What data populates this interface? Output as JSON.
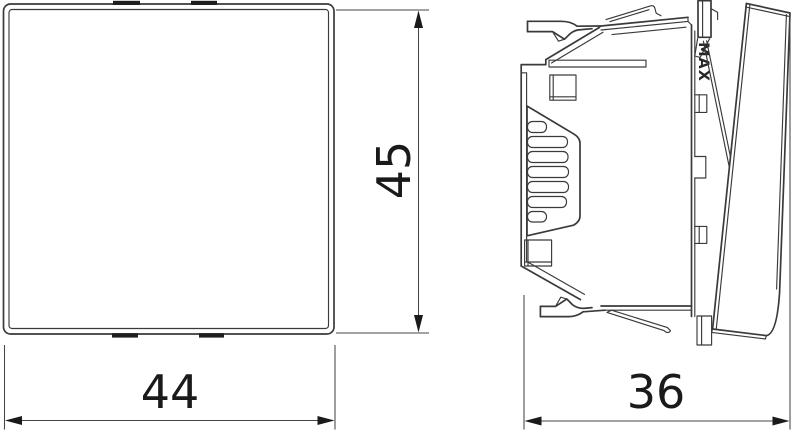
{
  "labels": {
    "width": "44",
    "height": "45",
    "depth": "36",
    "max_marking": "MAX"
  },
  "colors": {
    "background": "#ffffff",
    "drawing_line": "#3a3a3a",
    "dimension_line": "#454545",
    "text": "#1a1a1a"
  }
}
